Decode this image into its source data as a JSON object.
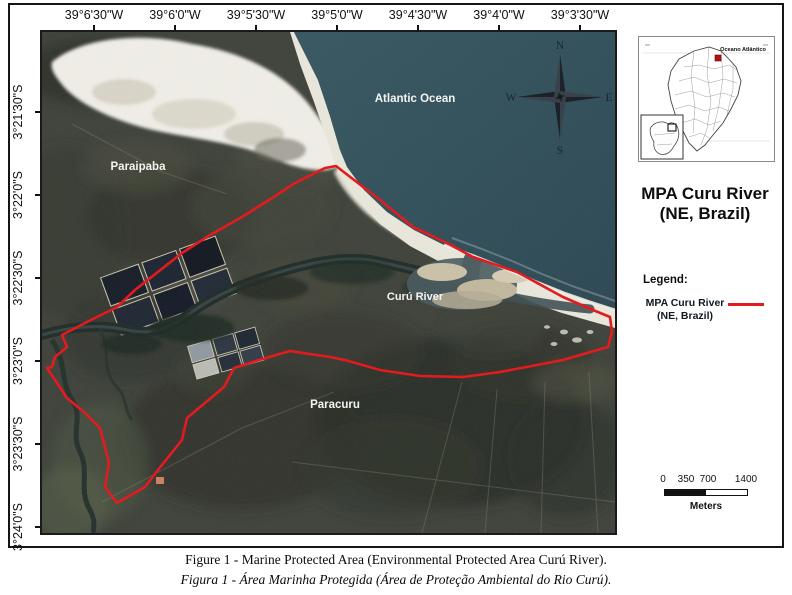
{
  "figure": {
    "caption_en": "Figure 1 - Marine Protected Area (Environmental Protected Area Curú River).",
    "caption_pt": "Figura 1 - Área Marinha Protegida (Área de Proteção Ambiental do Rio Curú)."
  },
  "map": {
    "lon_ticks": [
      {
        "label": "39°6'30\"W",
        "x": 94
      },
      {
        "label": "39°6'0\"W",
        "x": 175
      },
      {
        "label": "39°5'30\"W",
        "x": 256
      },
      {
        "label": "39°5'0\"W",
        "x": 337
      },
      {
        "label": "39°4'30\"W",
        "x": 418
      },
      {
        "label": "39°4'0\"W",
        "x": 499
      },
      {
        "label": "39°3'30\"W",
        "x": 580
      }
    ],
    "lat_ticks": [
      {
        "label": "3°21'30\"S",
        "y": 112
      },
      {
        "label": "3°22'0\"S",
        "y": 195
      },
      {
        "label": "3°22'30\"S",
        "y": 278
      },
      {
        "label": "3°23'0\"S",
        "y": 361
      },
      {
        "label": "3°23'30\"S",
        "y": 444
      },
      {
        "label": "3°24'0\"S",
        "y": 527
      }
    ],
    "labels": {
      "ocean": "Atlantic Ocean",
      "town_nw": "Paraipaba",
      "river": "Curú River",
      "town_s": "Paracuru"
    },
    "compass": {
      "n": "N",
      "e": "E",
      "s": "S",
      "w": "W"
    },
    "mpa_boundary_points": "294,134 283,136 253,151 227,168 200,185 168,203 140,221 93,258 75,275 43,291 20,303 25,315 13,325 10,335 5,336 25,366 43,381 58,396 63,415 67,431 63,455 75,471 103,455 116,438 140,408 145,386 182,355 192,336 217,328 248,319 288,325 303,328 338,338 378,344 421,345 458,340 521,328 566,315 570,300 568,285 551,278 521,265 475,240 431,225 403,210 371,195 338,168"
  },
  "side_panel": {
    "inset": {
      "ocean_label": "Oceano Atlântico"
    },
    "title_line1": "MPA Curu River",
    "title_line2": "(NE, Brazil)",
    "legend": {
      "heading": "Legend:",
      "item_line1": "MPA Curu River",
      "item_line2": "(NE, Brazil)"
    },
    "scale_bar": {
      "ticks": [
        "0",
        "350",
        "700",
        "1400"
      ],
      "tick_x": [
        663,
        686,
        708,
        746
      ],
      "unit": "Meters"
    }
  },
  "colors": {
    "mpa_line": "#e31b1e",
    "ocean_deep": "#31515c",
    "ocean_shore": "#2a4751",
    "sand": "#ebe8dd",
    "marker_red": "#b80f12"
  }
}
